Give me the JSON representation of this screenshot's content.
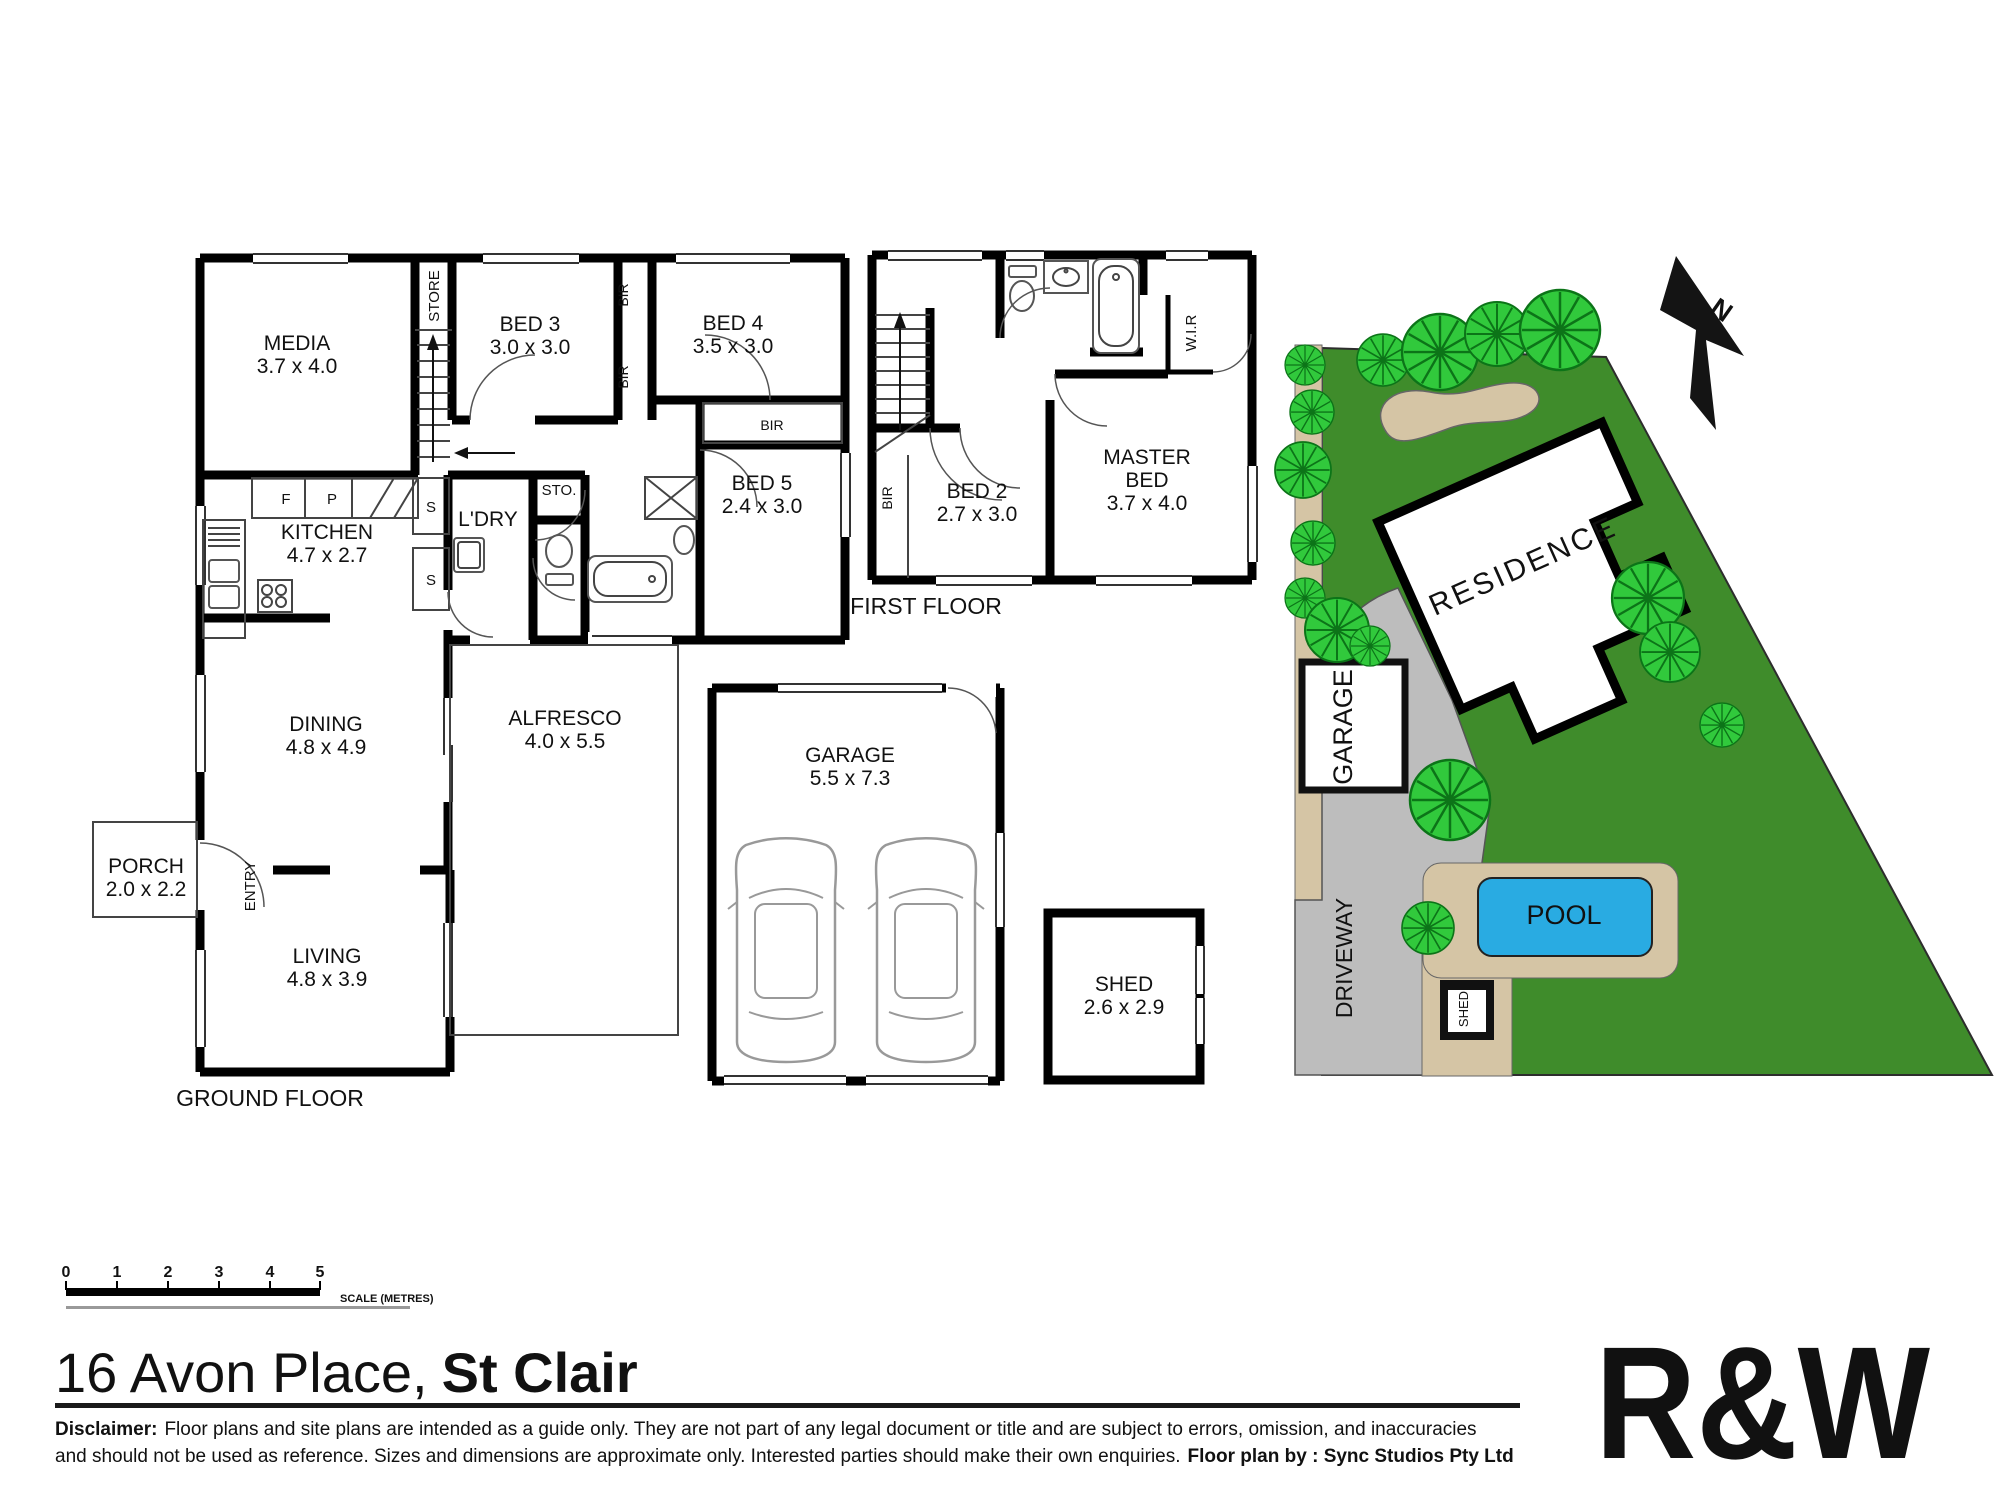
{
  "title": {
    "regular": "16 Avon Place,",
    "bold": "St Clair"
  },
  "floors": {
    "ground_label": "GROUND FLOOR",
    "first_label": "FIRST FLOOR"
  },
  "rooms": {
    "media": {
      "name": "MEDIA",
      "dims": "3.7 x 4.0"
    },
    "bed3": {
      "name": "BED 3",
      "dims": "3.0 x 3.0"
    },
    "bed4": {
      "name": "BED 4",
      "dims": "3.5 x 3.0"
    },
    "bed5": {
      "name": "BED 5",
      "dims": "2.4 x 3.0"
    },
    "kitchen": {
      "name": "KITCHEN",
      "dims": "4.7 x 2.7"
    },
    "dining": {
      "name": "DINING",
      "dims": "4.8 x 4.9"
    },
    "alfresco": {
      "name": "ALFRESCO",
      "dims": "4.0 x 5.5"
    },
    "porch": {
      "name": "PORCH",
      "dims": "2.0 x 2.2"
    },
    "living": {
      "name": "LIVING",
      "dims": "4.8 x 3.9"
    },
    "garage": {
      "name": "GARAGE",
      "dims": "5.5 x 7.3"
    },
    "shed": {
      "name": "SHED",
      "dims": "2.6 x 2.9"
    },
    "bed2": {
      "name": "BED 2",
      "dims": "2.7 x 3.0"
    },
    "master": {
      "name1": "MASTER",
      "name2": "BED",
      "dims": "3.7 x 4.0"
    }
  },
  "labels": {
    "store": "STORE",
    "ldry": "L'DRY",
    "sto": "STO.",
    "entry": "ENTRY",
    "wir": "W.I.R",
    "bir": "BIR",
    "fridge": "F",
    "pantry": "P",
    "shelf": "S"
  },
  "site": {
    "residence": "RESIDENCE",
    "garage": "GARAGE",
    "driveway": "DRIVEWAY",
    "pool": "POOL",
    "shed": "SHED",
    "north": "N"
  },
  "scale_bar": {
    "ticks": [
      "0",
      "1",
      "2",
      "3",
      "4",
      "5"
    ],
    "label": "SCALE (METRES)"
  },
  "footer": {
    "disclaimer_bold": "Disclaimer:",
    "disclaimer_line1": "Floor plans and site plans are intended as a guide only. They are not part of any legal document or title and are subject to errors, omission, and inaccuracies",
    "disclaimer_line2": "and should not be used as reference. Sizes and dimensions are approximate only. Interested parties should make their own enquiries.",
    "floorplan_by": "Floor plan by : Sync Studios Pty Ltd",
    "logo": "R&W"
  },
  "colors": {
    "grass": "#3F8C2B",
    "tree": "#31C93C",
    "tree_dark": "#0C7418",
    "driveway": "#BDBDBD",
    "path_tan": "#D5C5A5",
    "pool": "#29ABE2",
    "logo_red": "#E42A43",
    "wall": "#000000"
  }
}
